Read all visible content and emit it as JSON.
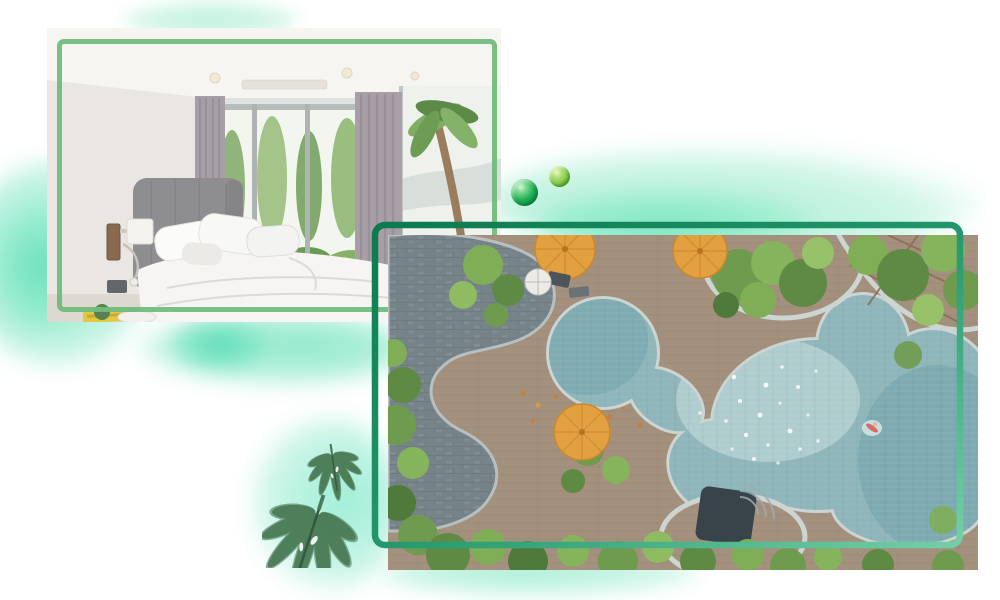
{
  "canvas": {
    "width": 1000,
    "height": 600,
    "background": "#ffffff"
  },
  "colors": {
    "page_bg": "#ffffff",
    "bedroom_frame_green": "#72ba7c",
    "pool_frame_dark": "#0c7a4f",
    "pool_frame_mid": "#22976b",
    "pool_frame_light": "#74cfa6",
    "watercolor_mint": "#a9eed3",
    "watercolor_teal": "#6fe0bd",
    "bead_dark_green": "#1fae52",
    "bead_light_green": "#6fbf3d",
    "leaf_green": "#4b7c57",
    "pool_water": "#8fb6ba",
    "deck_brown": "#a3907d",
    "stone_gray": "#75848b",
    "umbrella_orange": "#e3a041"
  },
  "scene": {
    "photos": [
      {
        "id": "bedroom-photo",
        "subject": "bedroom interior with garden view"
      },
      {
        "id": "pool-photo",
        "subject": "aerial view of free-form resort pool"
      }
    ],
    "decorations": [
      "watercolor-wash-top-left",
      "watercolor-wash-left",
      "watercolor-wash-mid",
      "watercolor-wash-under-bedroom",
      "watercolor-wash-leaves",
      "watercolor-wash-bottom",
      "glass-bead-large",
      "glass-bead-small",
      "monstera-leaf-small",
      "monstera-leaf-large",
      "bedroom-green-border",
      "pool-green-frame"
    ]
  }
}
